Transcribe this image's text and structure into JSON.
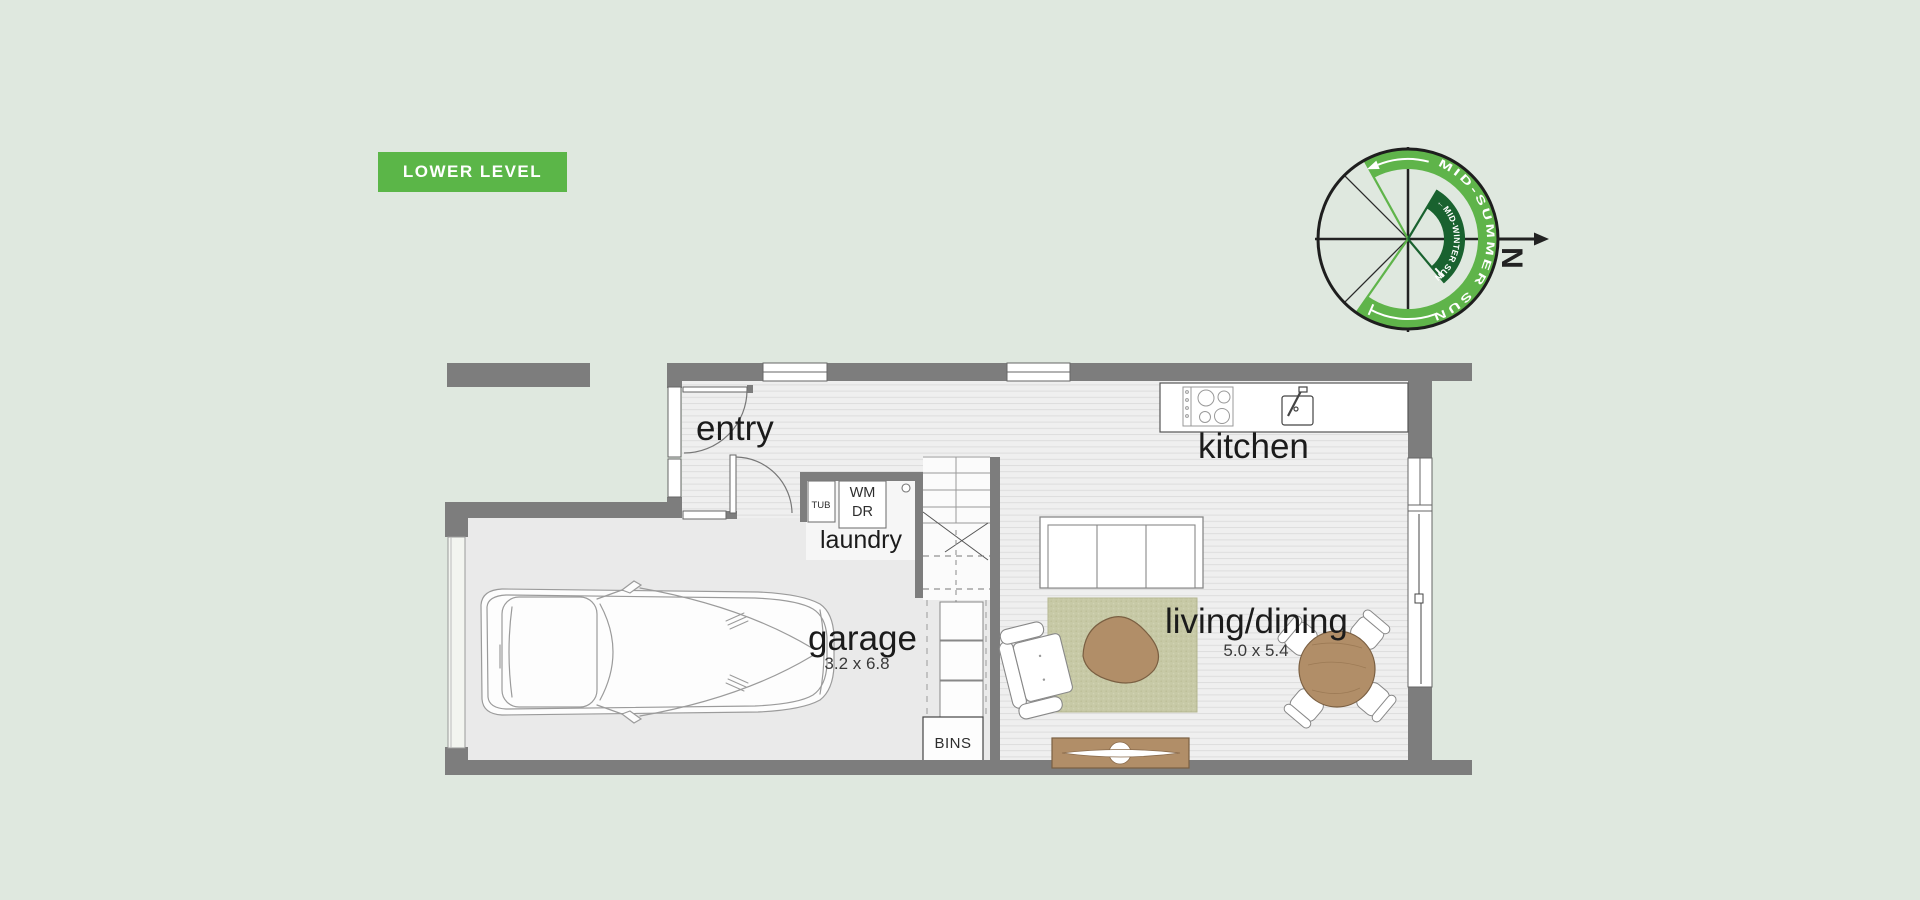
{
  "page": {
    "background_color": "#dfe8df"
  },
  "level_badge": {
    "label": "LOWER LEVEL",
    "bg_color": "#5bb648",
    "text_color": "#ffffff"
  },
  "compass": {
    "north_label": "N",
    "outer_band_label": "MID-SUMMER SUN",
    "inner_band_label": "←MID-WINTER SUN",
    "outer_band_color": "#5fb44a",
    "inner_band_color": "#19622f"
  },
  "floor_plan": {
    "wall_color": "#7d7d7d",
    "rooms": {
      "entry": {
        "label": "entry"
      },
      "laundry": {
        "label": "laundry",
        "appliances": {
          "tub": "TUB",
          "washing_machine": "WM",
          "dryer": "DR"
        }
      },
      "garage": {
        "label": "garage",
        "dimensions": "3.2 x 6.8"
      },
      "kitchen": {
        "label": "kitchen"
      },
      "living_dining": {
        "label": "living/dining",
        "dimensions": "5.0 x 5.4"
      },
      "storage": {
        "bins": "BINS"
      }
    }
  }
}
